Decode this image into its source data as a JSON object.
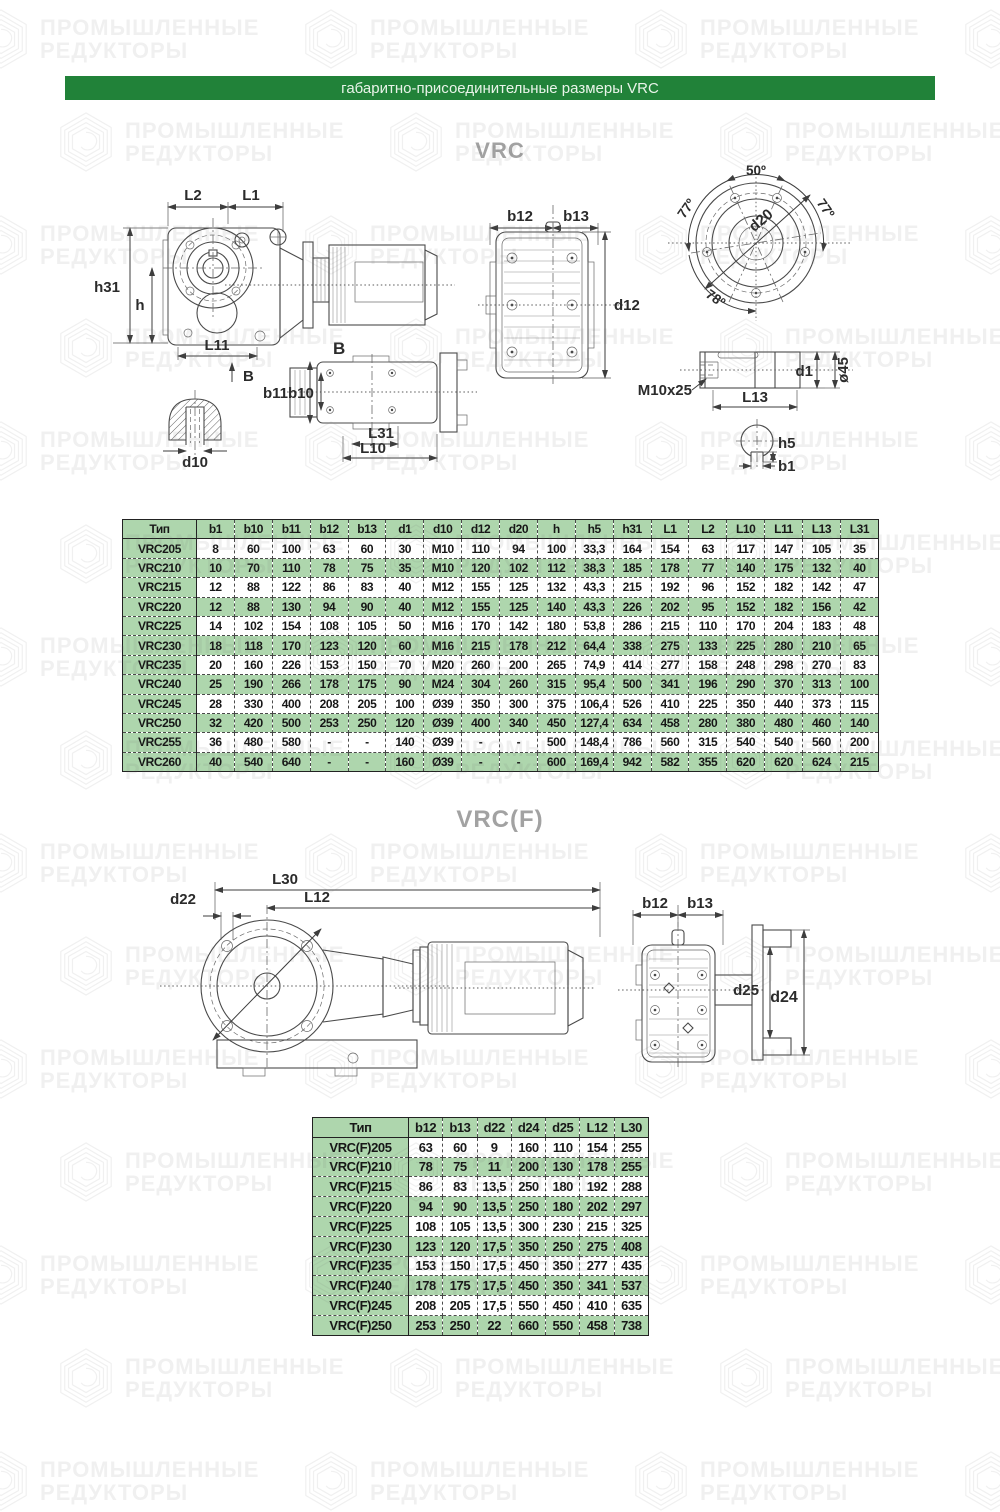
{
  "colors": {
    "header_green": "#218239",
    "table_green": "#aed6ad",
    "title_gray": "#a2a2a2"
  },
  "header": {
    "bar_title": "габаритно-присоединительные размеры VRC"
  },
  "watermark": {
    "line1": "ПРОМЫШЛЕННЫЕ",
    "line2": "РЕДУКТОРЫ"
  },
  "vrc": {
    "title": "VRC",
    "labels": {
      "L2": "L2",
      "L1": "L1",
      "h31": "h31",
      "h": "h",
      "L11": "L11",
      "B": "B",
      "d10": "d10",
      "b11": "b11",
      "b10": "b10",
      "L31": "L31",
      "L10": "L10",
      "b12": "b12",
      "b13": "b13",
      "d12": "d12",
      "deg50": "50º",
      "deg77_left": "77º",
      "deg77_right": "77º",
      "deg78": "78º",
      "d20": "d20",
      "thread": "M10x25",
      "L13": "L13",
      "d1": "d1",
      "dia45": "ø45",
      "h5": "h5",
      "b1": "b1"
    },
    "table": {
      "columns": [
        "Тип",
        "b1",
        "b10",
        "b11",
        "b12",
        "b13",
        "d1",
        "d10",
        "d12",
        "d20",
        "h",
        "h5",
        "h31",
        "L1",
        "L2",
        "L10",
        "L11",
        "L13",
        "L31"
      ],
      "rows": [
        [
          "VRC205",
          "8",
          "60",
          "100",
          "63",
          "60",
          "30",
          "M10",
          "110",
          "94",
          "100",
          "33,3",
          "164",
          "154",
          "63",
          "117",
          "147",
          "105",
          "35"
        ],
        [
          "VRC210",
          "10",
          "70",
          "110",
          "78",
          "75",
          "35",
          "M10",
          "120",
          "102",
          "112",
          "38,3",
          "185",
          "178",
          "77",
          "140",
          "175",
          "132",
          "40"
        ],
        [
          "VRC215",
          "12",
          "88",
          "122",
          "86",
          "83",
          "40",
          "M12",
          "155",
          "125",
          "132",
          "43,3",
          "215",
          "192",
          "96",
          "152",
          "182",
          "142",
          "47"
        ],
        [
          "VRC220",
          "12",
          "88",
          "130",
          "94",
          "90",
          "40",
          "M12",
          "155",
          "125",
          "140",
          "43,3",
          "226",
          "202",
          "95",
          "152",
          "182",
          "156",
          "42"
        ],
        [
          "VRC225",
          "14",
          "102",
          "154",
          "108",
          "105",
          "50",
          "M16",
          "170",
          "142",
          "180",
          "53,8",
          "286",
          "215",
          "110",
          "170",
          "204",
          "183",
          "48"
        ],
        [
          "VRC230",
          "18",
          "118",
          "170",
          "123",
          "120",
          "60",
          "M16",
          "215",
          "178",
          "212",
          "64,4",
          "338",
          "275",
          "133",
          "225",
          "280",
          "210",
          "65"
        ],
        [
          "VRC235",
          "20",
          "160",
          "226",
          "153",
          "150",
          "70",
          "M20",
          "260",
          "200",
          "265",
          "74,9",
          "414",
          "277",
          "158",
          "248",
          "298",
          "270",
          "83"
        ],
        [
          "VRC240",
          "25",
          "190",
          "266",
          "178",
          "175",
          "90",
          "M24",
          "304",
          "260",
          "315",
          "95,4",
          "500",
          "341",
          "196",
          "290",
          "370",
          "313",
          "100"
        ],
        [
          "VRC245",
          "28",
          "330",
          "400",
          "208",
          "205",
          "100",
          "Ø39",
          "350",
          "300",
          "375",
          "106,4",
          "526",
          "410",
          "225",
          "350",
          "440",
          "373",
          "115"
        ],
        [
          "VRC250",
          "32",
          "420",
          "500",
          "253",
          "250",
          "120",
          "Ø39",
          "400",
          "340",
          "450",
          "127,4",
          "634",
          "458",
          "280",
          "380",
          "480",
          "460",
          "140"
        ],
        [
          "VRC255",
          "36",
          "480",
          "580",
          "-",
          "-",
          "140",
          "Ø39",
          "-",
          "-",
          "500",
          "148,4",
          "786",
          "560",
          "315",
          "540",
          "540",
          "560",
          "200"
        ],
        [
          "VRC260",
          "40",
          "540",
          "640",
          "-",
          "-",
          "160",
          "Ø39",
          "-",
          "-",
          "600",
          "169,4",
          "942",
          "582",
          "355",
          "620",
          "620",
          "624",
          "215"
        ]
      ]
    }
  },
  "vrcf": {
    "title": "VRC(F)",
    "labels": {
      "L30": "L30",
      "L12": "L12",
      "d22": "d22",
      "b12": "b12",
      "b13": "b13",
      "d25": "d25",
      "d24": "d24"
    },
    "table": {
      "columns": [
        "Тип",
        "b12",
        "b13",
        "d22",
        "d24",
        "d25",
        "L12",
        "L30"
      ],
      "rows": [
        [
          "VRC(F)205",
          "63",
          "60",
          "9",
          "160",
          "110",
          "154",
          "255"
        ],
        [
          "VRC(F)210",
          "78",
          "75",
          "11",
          "200",
          "130",
          "178",
          "255"
        ],
        [
          "VRC(F)215",
          "86",
          "83",
          "13,5",
          "250",
          "180",
          "192",
          "288"
        ],
        [
          "VRC(F)220",
          "94",
          "90",
          "13,5",
          "250",
          "180",
          "202",
          "297"
        ],
        [
          "VRC(F)225",
          "108",
          "105",
          "13,5",
          "300",
          "230",
          "215",
          "325"
        ],
        [
          "VRC(F)230",
          "123",
          "120",
          "17,5",
          "350",
          "250",
          "275",
          "408"
        ],
        [
          "VRC(F)235",
          "153",
          "150",
          "17,5",
          "450",
          "350",
          "277",
          "435"
        ],
        [
          "VRC(F)240",
          "178",
          "175",
          "17,5",
          "450",
          "350",
          "341",
          "537"
        ],
        [
          "VRC(F)245",
          "208",
          "205",
          "17,5",
          "550",
          "450",
          "410",
          "635"
        ],
        [
          "VRC(F)250",
          "253",
          "250",
          "22",
          "660",
          "550",
          "458",
          "738"
        ]
      ]
    }
  }
}
